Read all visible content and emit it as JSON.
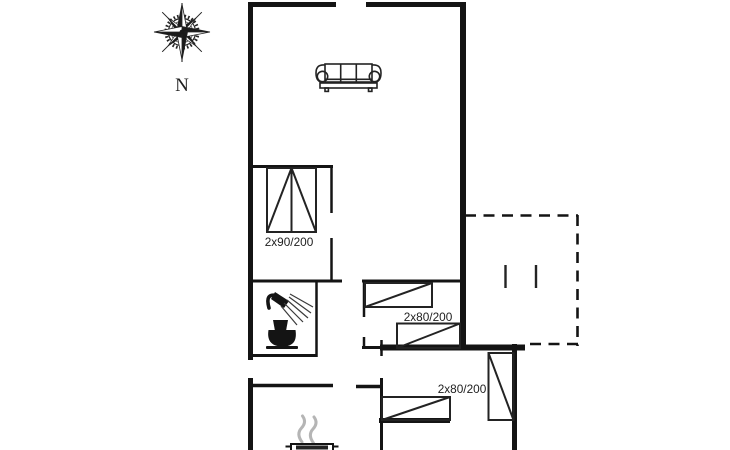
{
  "document": {
    "type": "floor-plan",
    "background": "#ffffff"
  },
  "compass": {
    "north_label": "N"
  },
  "beds": {
    "bedroom1_label": "2x90/200",
    "bedroom2_label": "2x80/200",
    "bedroom3_label": "2x80/200"
  },
  "colors": {
    "wall": "#141414",
    "line": "#232323",
    "text": "#1e1e1e",
    "smoke": "#b5b5b5"
  },
  "icons": {
    "compass": "compass-rose-icon",
    "living_room": "sofa-icon",
    "bathroom_1": "shower-icon",
    "bathroom_2": "toilet-icon",
    "lounge": "stove-icon"
  }
}
